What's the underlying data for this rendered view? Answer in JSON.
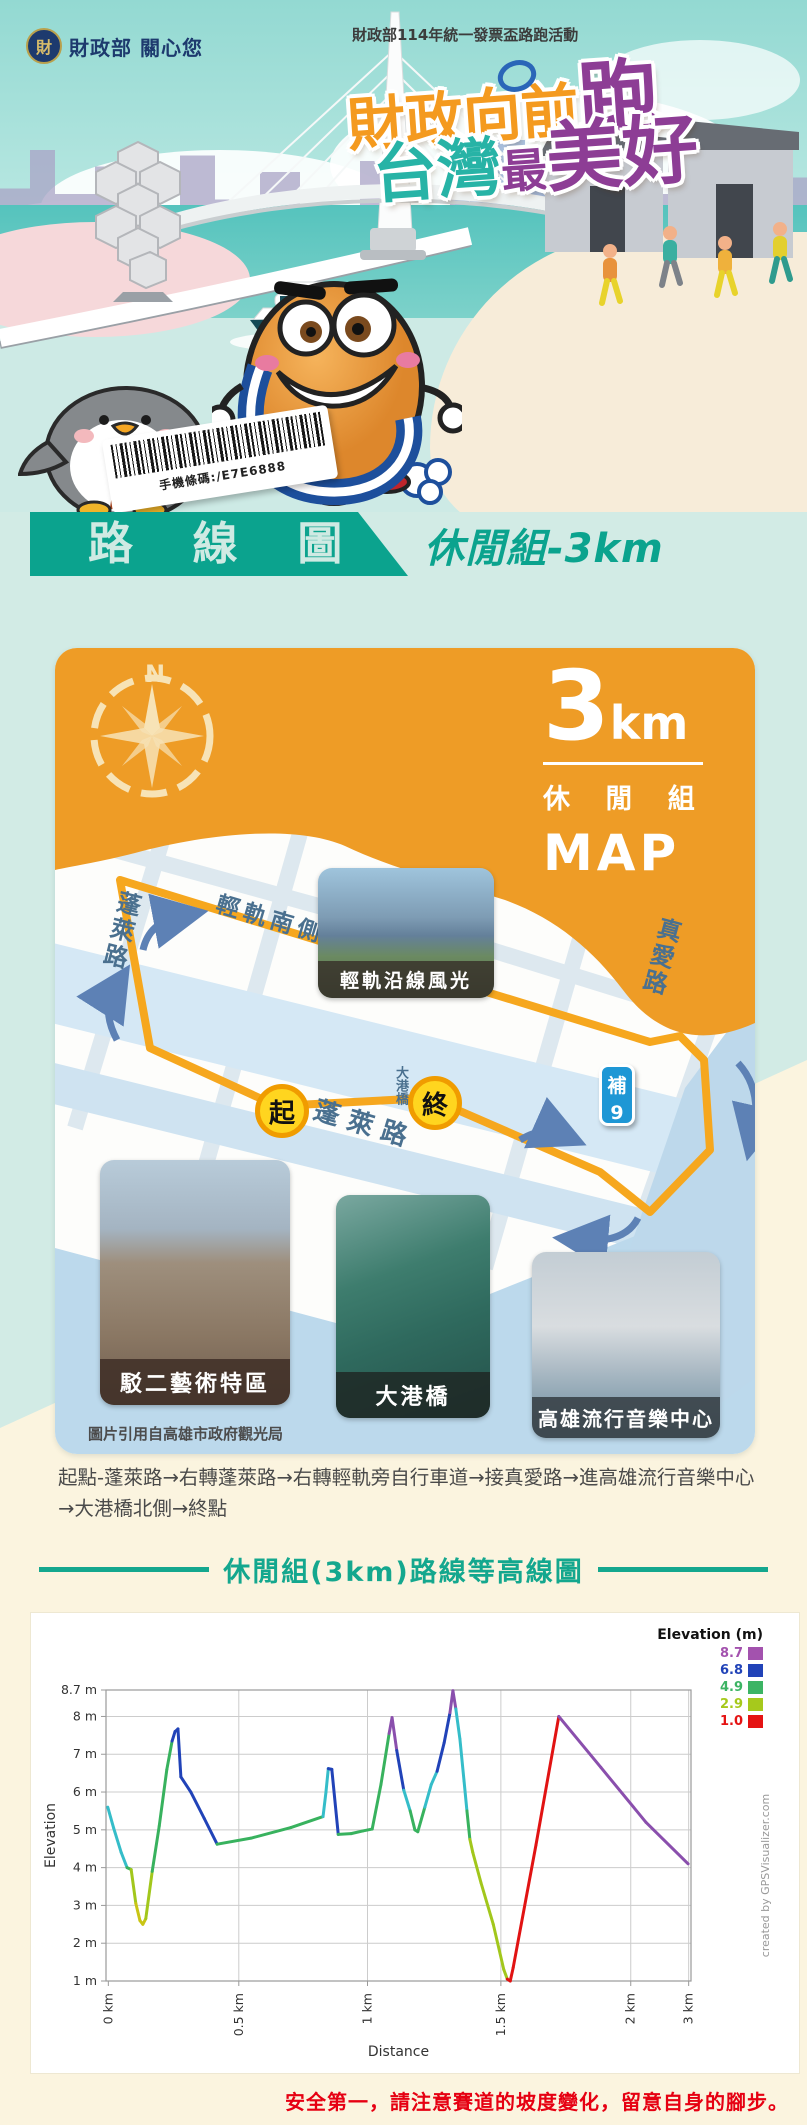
{
  "header": {
    "logo_text": "財政部 關心您",
    "logo_glyph": "財",
    "event_subtitle": "財政部114年統一發票盃路跑活動",
    "title_l1a": "財政向前",
    "title_l1b": "跑",
    "title_l2a": "台灣",
    "title_l2b": "最",
    "title_l2c": "美好",
    "barcode_text": "手機條碼:/E7E6888"
  },
  "banner": {
    "title": "路 線 圖",
    "subtitle": "休閒組-3km"
  },
  "map": {
    "compass_n": "N",
    "distance": "3",
    "distance_unit": "km",
    "group": "休 閒 組",
    "map_label": "MAP",
    "roads": {
      "bike_path": "輕軌南側自行車道",
      "penglai_left": "蓬萊路",
      "penglai_bottom": "蓬 萊 路",
      "zhenai": "真愛路",
      "dagang_bridge": "大港橋"
    },
    "markers": {
      "start": "起",
      "finish": "終",
      "aid_line1": "補",
      "aid_line2": "9"
    },
    "photos": [
      {
        "label": "輕軌沿線風光"
      },
      {
        "label": "駁二藝術特區"
      },
      {
        "label": "大港橋"
      },
      {
        "label": "高雄流行音樂中心"
      }
    ],
    "credit": "圖片引用自高雄市政府觀光局"
  },
  "route_description": {
    "text": "起點-蓬萊路→右轉蓬萊路→右轉輕軌旁自行車道→接真愛路→進高雄流行音樂中心→大港橋北側→終點"
  },
  "chart_section": {
    "title": "休閒組(3km)路線等高線圖"
  },
  "chart_data": {
    "type": "line",
    "title": "休閒組(3km)路線等高線圖",
    "xlabel": "Distance",
    "ylabel": "Elevation",
    "legend_title": "Elevation (m)",
    "legend": [
      {
        "label": "8.7",
        "color": "#a352ae"
      },
      {
        "label": "6.8",
        "color": "#2143b8"
      },
      {
        "label": "4.9",
        "color": "#3cb464"
      },
      {
        "label": "2.9",
        "color": "#a6c91c"
      },
      {
        "label": "1.0",
        "color": "#e51313"
      }
    ],
    "ylim": [
      1,
      8.7
    ],
    "y_ticks": [
      {
        "label": "8.7 m",
        "value": 8.7
      },
      {
        "label": "8 m",
        "value": 8
      },
      {
        "label": "7 m",
        "value": 7
      },
      {
        "label": "6 m",
        "value": 6
      },
      {
        "label": "5 m",
        "value": 5
      },
      {
        "label": "4 m",
        "value": 4
      },
      {
        "label": "3 m",
        "value": 3
      },
      {
        "label": "2 m",
        "value": 2
      },
      {
        "label": "1 m",
        "value": 1
      }
    ],
    "x_ticks": [
      {
        "label": "0 km",
        "pos": 0.004
      },
      {
        "label": "0.5 km",
        "pos": 0.227
      },
      {
        "label": "1 km",
        "pos": 0.447
      },
      {
        "label": "1.5 km",
        "pos": 0.675
      },
      {
        "label": "2 km",
        "pos": 0.897
      },
      {
        "label": "3 km",
        "pos": 0.996
      }
    ],
    "grid": true,
    "legend_position": "top-right",
    "watermark": "created by GPSVisualizer.com",
    "colors": {
      "c": "#35bdc9",
      "g": "#38b25e",
      "yg": "#a2c71c",
      "y": "#c9c515",
      "b": "#2143b8",
      "p": "#8a4fad",
      "r": "#e11313"
    },
    "profile_points": [
      [
        0.003,
        5.6,
        "c"
      ],
      [
        0.013,
        5.05,
        "c"
      ],
      [
        0.026,
        4.4,
        "c"
      ],
      [
        0.036,
        4.0,
        "c"
      ],
      [
        0.043,
        3.95,
        "g"
      ],
      [
        0.051,
        3.05,
        "yg"
      ],
      [
        0.058,
        2.6,
        "y"
      ],
      [
        0.063,
        2.5,
        "y"
      ],
      [
        0.068,
        2.65,
        "y"
      ],
      [
        0.079,
        3.9,
        "yg"
      ],
      [
        0.091,
        5.1,
        "g"
      ],
      [
        0.104,
        6.6,
        "g"
      ],
      [
        0.113,
        7.35,
        "g"
      ],
      [
        0.118,
        7.6,
        "b"
      ],
      [
        0.123,
        7.67,
        "b"
      ],
      [
        0.128,
        6.4,
        "b"
      ],
      [
        0.145,
        6.0,
        "b"
      ],
      [
        0.168,
        5.3,
        "b"
      ],
      [
        0.19,
        4.62,
        "b"
      ],
      [
        0.248,
        4.78,
        "g"
      ],
      [
        0.316,
        5.06,
        "g"
      ],
      [
        0.371,
        5.35,
        "g"
      ],
      [
        0.376,
        6.0,
        "c"
      ],
      [
        0.38,
        6.62,
        "c"
      ],
      [
        0.386,
        6.6,
        "b"
      ],
      [
        0.397,
        4.88,
        "b"
      ],
      [
        0.419,
        4.9,
        "g"
      ],
      [
        0.439,
        4.97,
        "g"
      ],
      [
        0.455,
        5.02,
        "g"
      ],
      [
        0.47,
        6.2,
        "g"
      ],
      [
        0.484,
        7.55,
        "g"
      ],
      [
        0.489,
        7.97,
        "p"
      ],
      [
        0.497,
        7.1,
        "p"
      ],
      [
        0.509,
        6.05,
        "b"
      ],
      [
        0.52,
        5.5,
        "c"
      ],
      [
        0.528,
        5.0,
        "g"
      ],
      [
        0.533,
        4.95,
        "g"
      ],
      [
        0.545,
        5.6,
        "g"
      ],
      [
        0.556,
        6.2,
        "c"
      ],
      [
        0.566,
        6.55,
        "c"
      ],
      [
        0.578,
        7.3,
        "b"
      ],
      [
        0.588,
        8.1,
        "b"
      ],
      [
        0.593,
        8.68,
        "p"
      ],
      [
        0.598,
        8.2,
        "p"
      ],
      [
        0.605,
        7.4,
        "c"
      ],
      [
        0.612,
        6.3,
        "c"
      ],
      [
        0.617,
        5.5,
        "c"
      ],
      [
        0.622,
        4.75,
        "g"
      ],
      [
        0.627,
        4.4,
        "yg"
      ],
      [
        0.641,
        3.6,
        "yg"
      ],
      [
        0.662,
        2.5,
        "yg"
      ],
      [
        0.68,
        1.3,
        "yg"
      ],
      [
        0.686,
        1.05,
        "yg"
      ],
      [
        0.691,
        1.0,
        "r"
      ],
      [
        0.696,
        1.35,
        "r"
      ],
      [
        0.735,
        4.6,
        "r"
      ],
      [
        0.774,
        8.0,
        "r"
      ],
      [
        0.846,
        6.65,
        "p"
      ],
      [
        0.923,
        5.2,
        "p"
      ],
      [
        0.995,
        4.1,
        "p"
      ]
    ]
  },
  "footer": {
    "safety_note": "安全第一，請注意賽道的坡度變化，留意自身的腳步。"
  }
}
